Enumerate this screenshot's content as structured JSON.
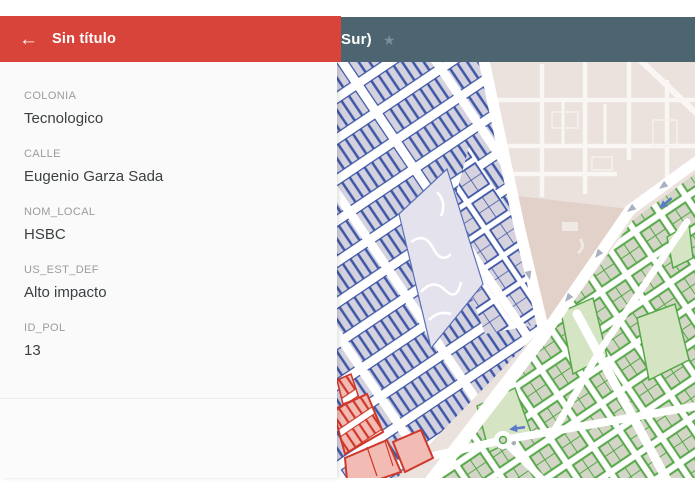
{
  "colors": {
    "panel_red": "#d8443a",
    "top_bar": "#4d6570",
    "panel_bg": "#fafafa",
    "label_grey": "#9b9b9b",
    "value_dark": "#3c4043",
    "road_white": "#ffffff",
    "map_bg": "#ebe1dd",
    "map_tan_wedge": "#e2d1c9",
    "map_blue_outline": "#3e56a6",
    "map_blue_fill": "#d3d2de",
    "map_green_outline": "#55a847",
    "map_green_fill": "#d3d5c6",
    "map_green_park": "#d5e5c3",
    "map_red_outline": "#cf382b",
    "map_red_fill": "#f2bcb4"
  },
  "info_panel": {
    "back_icon": "←",
    "title": "Sin título",
    "fields": [
      {
        "label": "COLONIA",
        "value": "Tecnologico"
      },
      {
        "label": "CALLE",
        "value": "Eugenio Garza Sada"
      },
      {
        "label": "NOM_LOCAL",
        "value": "HSBC"
      },
      {
        "label": "US_EST_DEF",
        "value": "Alto impacto"
      },
      {
        "label": "ID_POL",
        "value": "13"
      }
    ]
  },
  "map_bar": {
    "title_visible": "Sur)",
    "star_icon": "★"
  }
}
